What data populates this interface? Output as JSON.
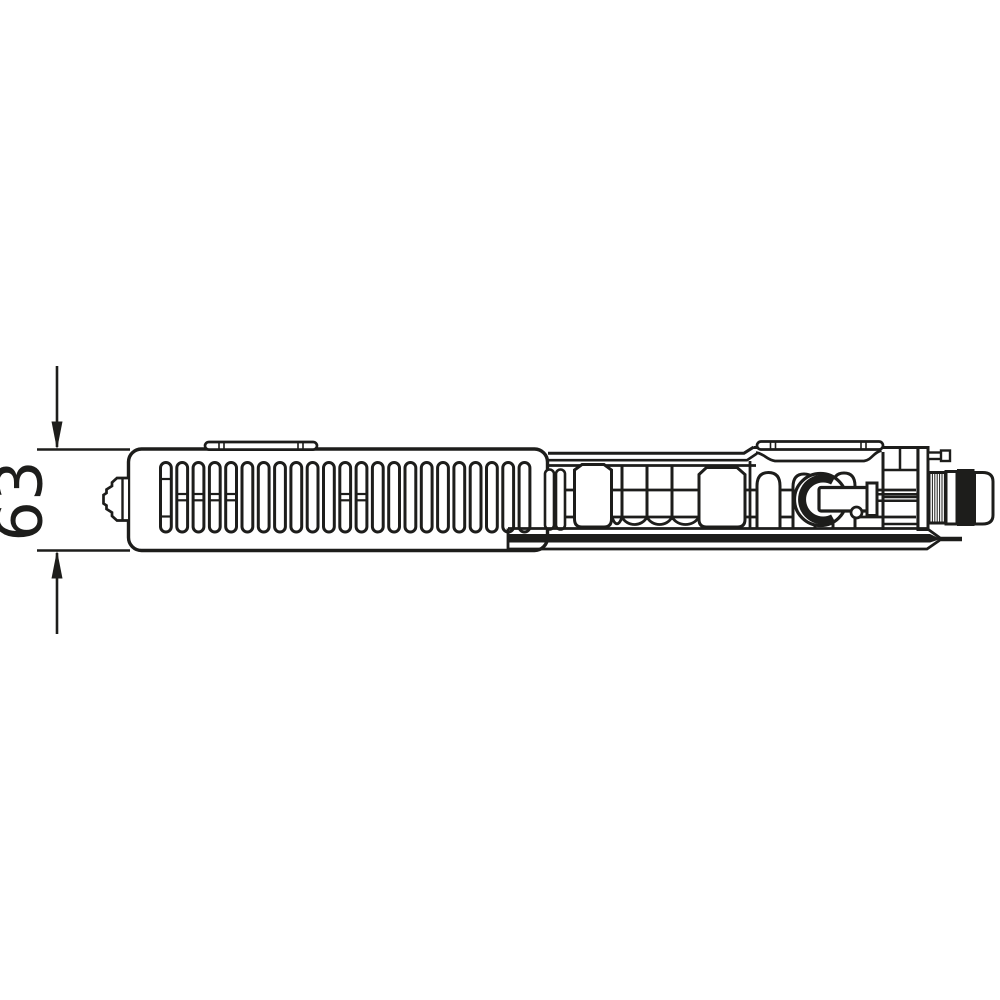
{
  "meta": {
    "description": "Technical line drawing: top sectional view of a flat panel radiator with ventilation grille, convector fins and integrated valve connection",
    "background_color": "#ffffff"
  },
  "colors": {
    "line": "#1d1d1b",
    "paper": "#ffffff"
  },
  "dimension": {
    "label": "63",
    "orientation": "vertical",
    "measures": "radiator depth"
  },
  "front_panel": {
    "grille": {
      "count": 23,
      "x0": 160.5,
      "pitch": 16.3,
      "width": 10.8,
      "y_top": 462.5,
      "y_bottom": 532,
      "rx": 5.4,
      "crossbars": {
        "0": [
          479,
          516.5
        ],
        "1": [
          494,
          500.3
        ],
        "2": [
          494,
          500.3
        ],
        "3": [
          494,
          500.3
        ],
        "4": [
          494,
          500.3
        ],
        "11": [
          494,
          500.3
        ],
        "12": [
          494,
          500.3
        ]
      }
    }
  },
  "thread_hatch": {
    "x_start": 930,
    "x_end": 944.5,
    "step": 2.4,
    "y_top": 474,
    "y_bottom": 521.5
  }
}
